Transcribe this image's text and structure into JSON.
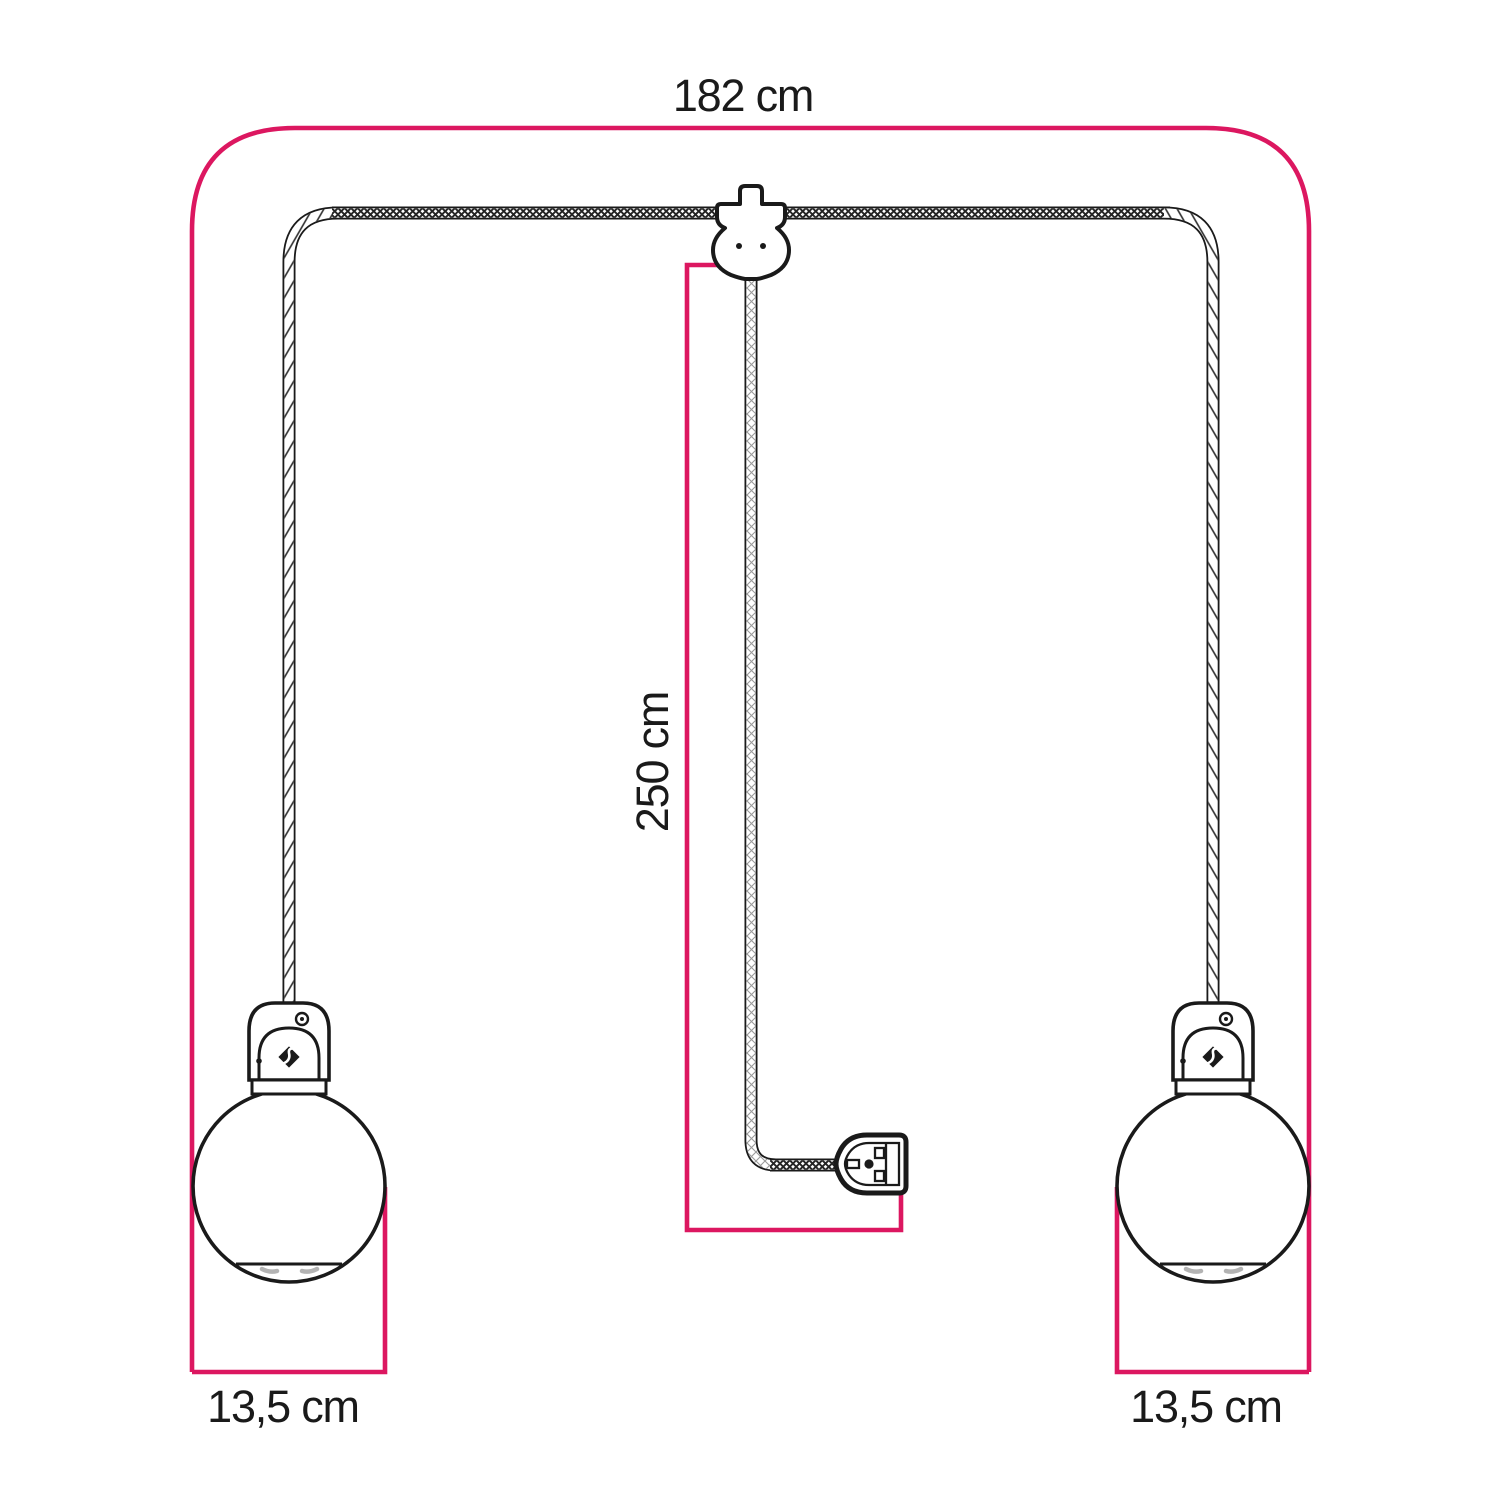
{
  "diagram": {
    "labels": {
      "total_width": "182 cm",
      "drop_length": "250 cm",
      "left_globe_diameter": "13,5 cm",
      "right_globe_diameter": "13,5 cm"
    },
    "colors": {
      "dimension_pink": "#dc1760",
      "line_black": "#1a1a1a",
      "background": "#ffffff",
      "shade_gray": "#b3b3b3"
    },
    "components": {
      "hook": "ceiling-cable-hook-icon",
      "plug": "uk-plug-icon",
      "cable": "braided-textile-cable",
      "left_lamp": "globe-pendant-lamp",
      "right_lamp": "globe-pendant-lamp",
      "logo": "brand-flame-icon"
    }
  }
}
